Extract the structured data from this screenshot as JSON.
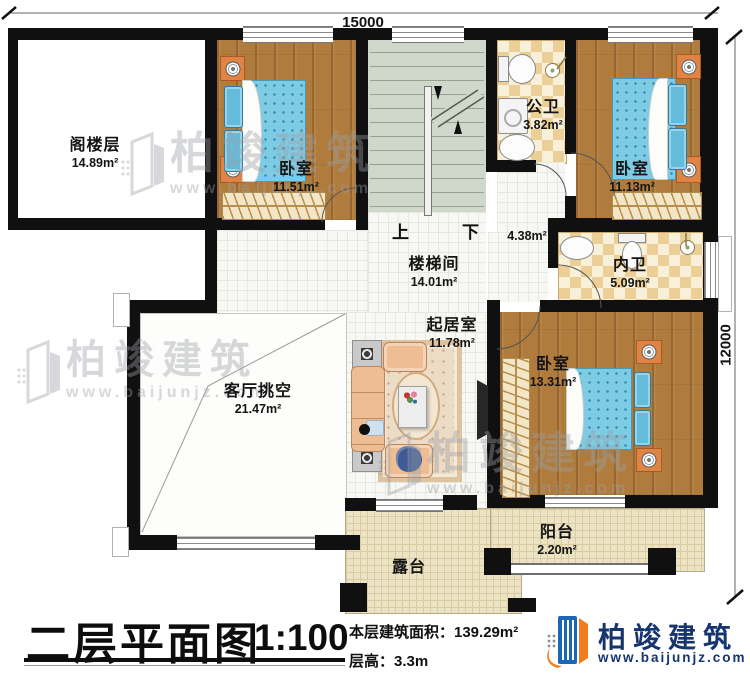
{
  "dimensions": {
    "top": "15000",
    "right": "12000"
  },
  "rooms": {
    "attic": {
      "name": "阁楼层",
      "area": "14.89m²"
    },
    "bedroom1": {
      "name": "卧室",
      "area": "11.51m²"
    },
    "stairwell": {
      "name": "楼梯间",
      "area": "14.01m²"
    },
    "public_bath": {
      "name": "公卫",
      "area": "3.82m²"
    },
    "bedroom2": {
      "name": "卧室",
      "area": "11.13m²"
    },
    "hallway": {
      "area": "4.38m²"
    },
    "inner_bath": {
      "name": "内卫",
      "area": "5.09m²"
    },
    "sitting_room": {
      "name": "起居室",
      "area": "11.78m²"
    },
    "living_void": {
      "name": "客厅挑空",
      "area": "21.47m²"
    },
    "bedroom3": {
      "name": "卧室",
      "area": "13.31m²"
    },
    "balcony": {
      "name": "阳台",
      "area": "2.20m²"
    },
    "terrace": {
      "name": "露台"
    }
  },
  "stairs": {
    "up_label": "上",
    "down_label": "下"
  },
  "title_block": {
    "title": "二层平面图",
    "scale": "1:100",
    "area_text": "本层建筑面积：139.29m²",
    "floor_height_text": "层高：3.3m"
  },
  "brand": {
    "name": "柏竣建筑",
    "url": "www.baijunjz.com"
  },
  "watermark": {
    "text": "柏竣建筑",
    "url": "www.baijunjz.com"
  },
  "colors": {
    "wall": "#101010",
    "wood": "#b07c3e",
    "mattress": "#7ecbe4",
    "checker": "#ebcf97",
    "stair": "#cfd8ca",
    "terrace": "#ece2c4",
    "brand_navy": "#16356e",
    "brand_orange": "#f07d1e",
    "brand_blue": "#1b66b5"
  }
}
